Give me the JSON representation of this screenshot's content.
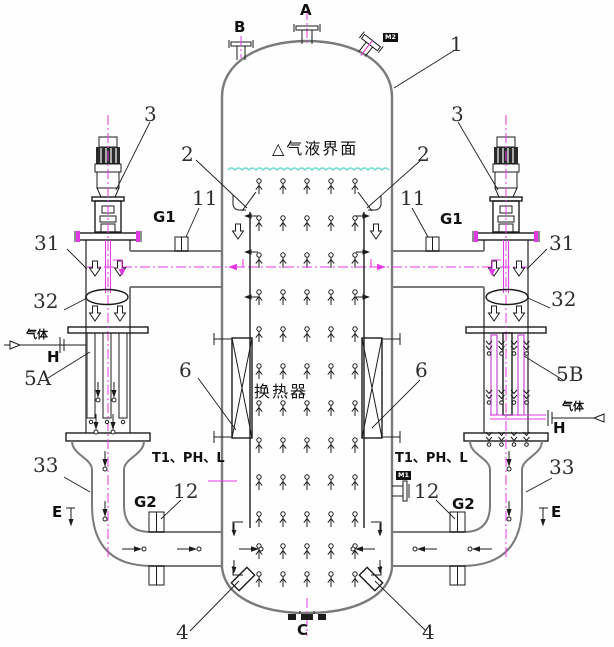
{
  "part_labels": {
    "p1": "1",
    "p2": "2",
    "p3": "3",
    "p4": "4",
    "p5a": "5A",
    "p5b": "5B",
    "p6": "6",
    "p11": "11",
    "p12": "12",
    "p31": "31",
    "p32": "32",
    "p33": "33"
  },
  "nozzle_labels": {
    "a": "A",
    "b": "B",
    "c": "C",
    "e": "E",
    "h": "H",
    "g1": "G1",
    "g2": "G2",
    "m1": "M1",
    "m2": "M2"
  },
  "annotations": {
    "gas_liquid_interface": "△气液界面",
    "heat_exchanger": "换热器",
    "gas": "气体",
    "instruments": "T1、PH、L"
  },
  "colors": {
    "shell_gray": "#7a7a7a",
    "line_black": "#1c1c1c",
    "centerline_magenta": "#e23ae2",
    "interface_cyan": "#74d9d0"
  }
}
